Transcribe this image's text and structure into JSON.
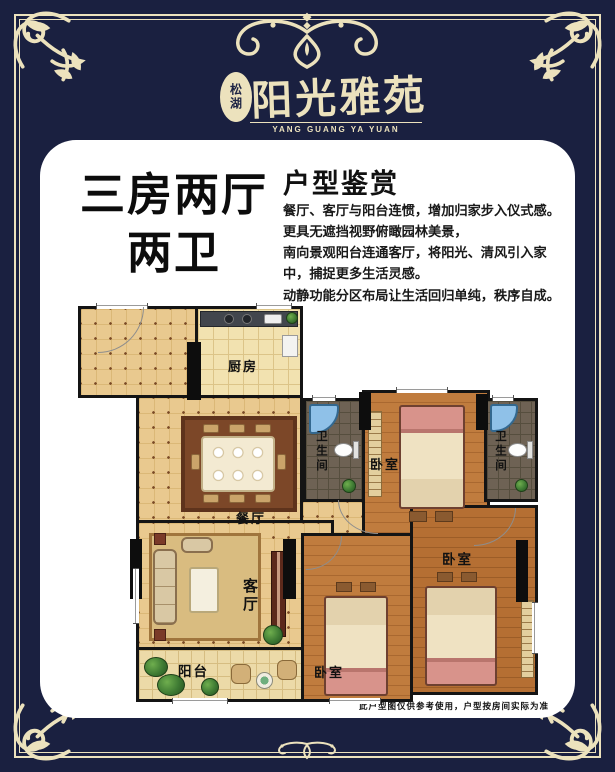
{
  "brand": {
    "badge": "松湖",
    "name": "阳光雅苑",
    "name_en": "YANG GUANG YA YUAN"
  },
  "headline": {
    "line1": "三房两厅",
    "line2": "两卫"
  },
  "section": {
    "heading": "户型鉴赏",
    "lines": [
      "餐厅、客厅与阳台连惯，增加归家步入仪式感。",
      "更具无遮挡视野俯瞰园林美景，",
      "南向景观阳台连通客厅，将阳光、清风引入家",
      "中，捕捉更多生活灵感。",
      "动静功能分区布局让生活回归单纯，秩序自成。"
    ]
  },
  "floorplan": {
    "rooms": [
      {
        "id": "kitchen",
        "label": "厨房"
      },
      {
        "id": "dining",
        "label": "餐厅"
      },
      {
        "id": "bathroom-left",
        "label": "卫生间"
      },
      {
        "id": "bedroom-top",
        "label": "卧室"
      },
      {
        "id": "bathroom-right",
        "label": "卫生间"
      },
      {
        "id": "living",
        "label": "客厅"
      },
      {
        "id": "balcony",
        "label": "阳台"
      },
      {
        "id": "bedroom-bottom",
        "label": "卧室"
      },
      {
        "id": "bedroom-right",
        "label": "卧室"
      }
    ]
  },
  "disclaimer": "此户型图仅供参考使用，户型按房间实际为准",
  "colors": {
    "background": "#1a2040",
    "gold": "#ece2bd",
    "card": "#ffffff",
    "wall": "#141414",
    "tile_floor": "#e9c98f",
    "wood_floor": "#c07c3e",
    "bath_floor": "#6e6254",
    "shower_blue": "#8fc1e8"
  }
}
